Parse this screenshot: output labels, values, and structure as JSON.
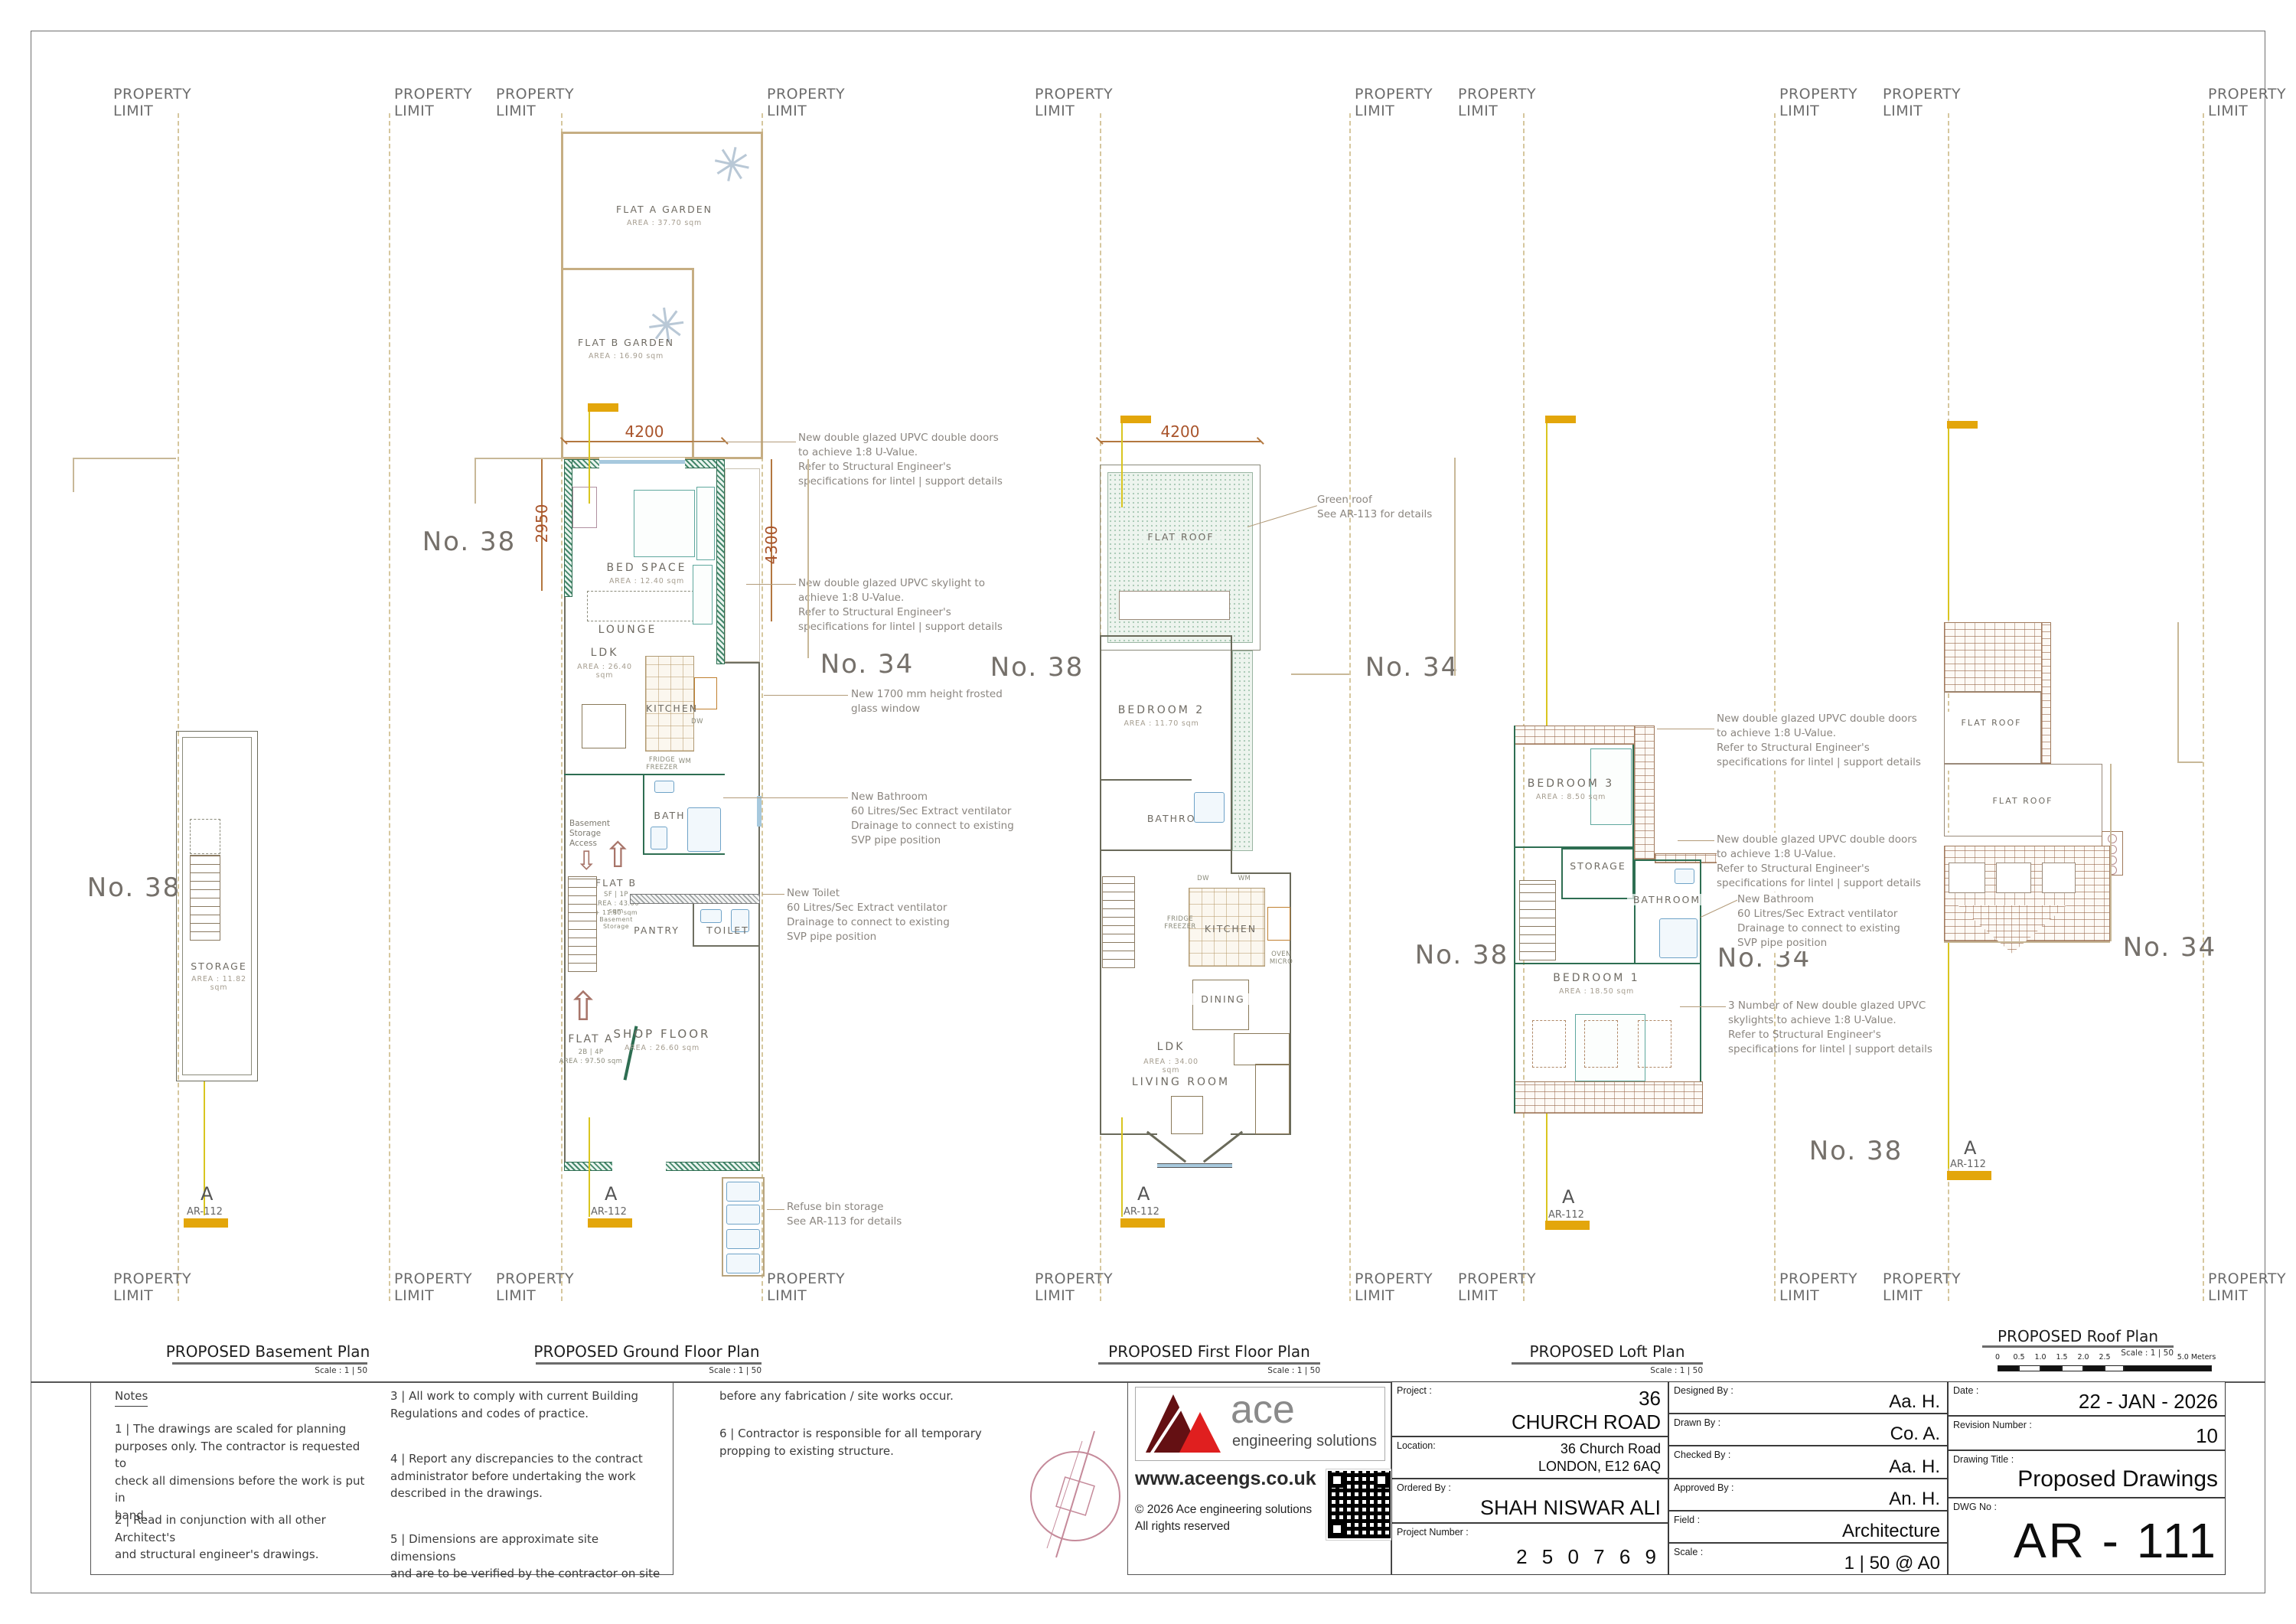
{
  "sheet": {
    "property_limit": "PROPERTY\nLIMIT",
    "section_letter": "A",
    "section_ref": "AR-112",
    "scale_label": "Scale : 1 | 50"
  },
  "icons": {
    "tree": "✳",
    "arrow_up": "⇧",
    "arrow_down": "⇩"
  },
  "annotations": {
    "upvc_doors": "New double glazed UPVC  double doors\nto achieve 1:8 U-Value.\nRefer to Structural Engineer's\nspecifications for lintel | support details",
    "upvc_skylight": "New double glazed UPVC  skylight to\nachieve 1:8 U-Value.\nRefer to Structural Engineer's\nspecifications for lintel | support details",
    "frosted_window": "New 1700 mm height frosted\nglass window",
    "new_bathroom": "New Bathroom\n60 Litres/Sec Extract ventilator\nDrainage to connect to existing\nSVP pipe position",
    "new_toilet": "New Toilet\n60 Litres/Sec Extract ventilator\nDrainage to connect to existing\nSVP pipe position",
    "refuse": "Refuse bin storage\nSee AR-113 for details",
    "green_roof": "Green roof\nSee AR-113 for details",
    "skylights3": "3 Number of New double glazed UPVC\nskylights to achieve 1:8 U-Value.\nRefer to Structural Engineer's\nspecifications for lintel | support details"
  },
  "basement": {
    "title": "PROPOSED Basement Plan",
    "no38": "No. 38",
    "storage": "STORAGE",
    "storage_area": "AREA : 11.82 sqm"
  },
  "ground": {
    "title": "PROPOSED Ground Floor Plan",
    "no38": "No. 38",
    "no34": "No. 34",
    "flat_a_garden": "FLAT A GARDEN",
    "flat_a_garden_area": "AREA : 37.70 sqm",
    "flat_b_garden": "FLAT B GARDEN",
    "flat_b_garden_area": "AREA : 16.90 sqm",
    "dim_top": "4200",
    "dim_left": "2950",
    "dim_right": "4300",
    "bed_space": "BED SPACE",
    "bed_space_area": "AREA : 12.40 sqm",
    "lounge": "LOUNGE",
    "ldk": "LDK",
    "ldk_area": "AREA : 26.40 sqm",
    "kitchen": "KITCHEN",
    "dw": "DW",
    "wm": "WM",
    "fridge": "FRIDGE\nFREEZER",
    "bath": "BATH",
    "basement_access": "Basement\nStorage\nAccess",
    "flat_b": "FLAT B",
    "flat_b_occ": "SF | 1P",
    "flat_b_area": "AREA : 43.00 sqm",
    "flat_b_extra": "+ 11.80 sqm\nBasement\nStorage",
    "pantry": "PANTRY",
    "toilet": "TOILET",
    "flat_a": "FLAT A",
    "flat_a_occ": "2B | 4P",
    "flat_a_area": "AREA : 97.50 sqm",
    "shop_floor": "SHOP FLOOR",
    "shop_floor_area": "AREA : 26.60 sqm"
  },
  "first": {
    "title": "PROPOSED First Floor Plan",
    "no38": "No. 38",
    "no34": "No. 34",
    "dim_top": "4200",
    "flat_roof": "FLAT ROOF",
    "bedroom2": "BEDROOM 2",
    "bedroom2_area": "AREA : 11.70 sqm",
    "bathroom": "BATHROOM",
    "kitchen": "KITCHEN",
    "dw": "DW",
    "wm": "WM",
    "fridge": "FRIDGE\nFREEZER",
    "oven": "OVEN\nMICRO",
    "dining": "DINING",
    "ldk": "LDK",
    "ldk_area": "AREA : 34.00 sqm",
    "living": "LIVING ROOM"
  },
  "loft": {
    "title": "PROPOSED Loft Plan",
    "no38": "No. 38",
    "no34": "No. 34",
    "bedroom3": "BEDROOM 3",
    "bedroom3_area": "AREA : 8.50 sqm",
    "storage": "STORAGE",
    "bathroom": "BATHROOM",
    "bedroom1": "BEDROOM 1",
    "bedroom1_area": "AREA : 18.50 sqm"
  },
  "roof": {
    "title": "PROPOSED Roof Plan",
    "no38": "No. 38",
    "no34": "No. 34",
    "flat_roof_upper": "FLAT ROOF",
    "flat_roof_lower": "FLAT ROOF"
  },
  "scalebar": {
    "ticks": [
      "0",
      "0.5",
      "1.0",
      "1.5",
      "2.0",
      "2.5"
    ],
    "end": "5.0 Meters"
  },
  "notes": {
    "heading": "Notes",
    "n1": "1 | The drawings are scaled for planning\npurposes only. The contractor is requested to\ncheck all dimensions before the work is put in\nhand.",
    "n2": "2 | Read in conjunction with all other Architect's\nand structural engineer's drawings.",
    "n3": "3 | All work to comply with current Building\nRegulations and codes of practice.",
    "n4": "4 | Report any discrepancies to the contract\nadministrator before undertaking the work\ndescribed in the drawings.",
    "n5": "5 | Dimensions are approximate site dimensions\nand are to be verified by the contractor on site",
    "n5b": "before any fabrication / site works occur.",
    "n6": "6 | Contractor is responsible for all temporary\npropping to existing structure."
  },
  "logo": {
    "brand": "ace",
    "tagline": "engineering solutions",
    "url": "www.aceengs.co.uk",
    "copyright": "© 2026 Ace engineering solutions\nAll rights reserved"
  },
  "titleblock": {
    "project_label": "Project :",
    "project_value": "36\nCHURCH ROAD",
    "location_label": "Location:",
    "location_value": "36 Church Road\nLONDON, E12 6AQ",
    "ordered_label": "Ordered By :",
    "ordered_value": "SHAH NISWAR ALI",
    "projnum_label": "Project Number :",
    "projnum_value": "2 5 0 7 6 9",
    "designed_label": "Designed By :",
    "designed_value": "Aa. H.",
    "drawn_label": "Drawn By :",
    "drawn_value": "Co. A.",
    "checked_label": "Checked By :",
    "checked_value": "Aa. H.",
    "approved_label": "Approved By :",
    "approved_value": "An. H.",
    "field_label": "Field :",
    "field_value": "Architecture",
    "scale_label": "Scale :",
    "scale_value": "1 | 50 @ A0",
    "date_label": "Date :",
    "date_value": "22 - JAN - 2026",
    "revision_label": "Revision Number :",
    "revision_value": "10",
    "title_label": "Drawing Title :",
    "title_value": "Proposed Drawings",
    "dwg_label": "DWG No :",
    "dwg_value": "AR - 111"
  },
  "colors": {
    "wall-green": "#2e6e52",
    "wall-hatch": "#44876b",
    "accent-orange": "#e3a60b",
    "section-yellow": "#d9c520",
    "dim-brown": "#a9542b",
    "fence-tan": "#c6ae83",
    "glazing-blue": "#a7c9de",
    "roof-brown": "#9a6a4c",
    "stipple-green": "#a9c9b5",
    "logo-red": "#e01f1f",
    "logo-maroon": "#641013"
  }
}
